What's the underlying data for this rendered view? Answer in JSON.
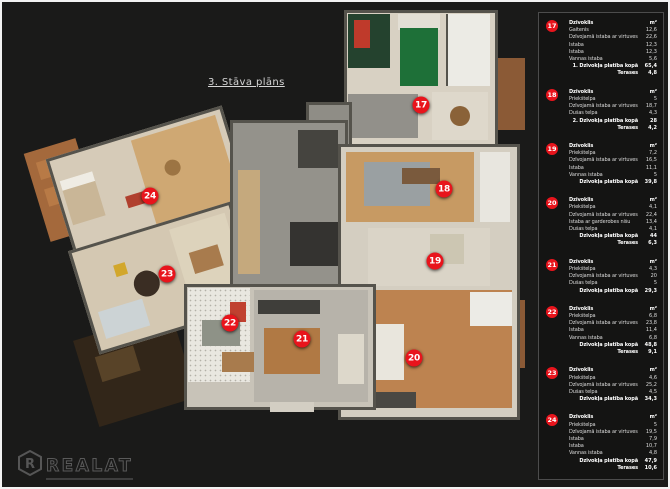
{
  "title": "3. Stāva plāns",
  "logo": {
    "symbol": "R",
    "text": "REALAT"
  },
  "plan": {
    "marker_color": "#e8141c",
    "markers": [
      {
        "id": "17",
        "x": 419,
        "y": 103
      },
      {
        "id": "18",
        "x": 442,
        "y": 187
      },
      {
        "id": "19",
        "x": 433,
        "y": 259
      },
      {
        "id": "20",
        "x": 412,
        "y": 356
      },
      {
        "id": "21",
        "x": 300,
        "y": 337
      },
      {
        "id": "22",
        "x": 228,
        "y": 321
      },
      {
        "id": "23",
        "x": 165,
        "y": 272
      },
      {
        "id": "24",
        "x": 148,
        "y": 194
      }
    ]
  },
  "sidebar": {
    "header_label": "Dzīvoklis",
    "unit_label": "m²",
    "apartments": [
      {
        "id": "17",
        "rows": [
          [
            "Gaitenis",
            "12,6"
          ],
          [
            "Dzīvojamā istaba ar virtuves nišu",
            "22,6"
          ],
          [
            "Istaba",
            "12,3"
          ],
          [
            "Istaba",
            "12,3"
          ],
          [
            "Vannas istaba",
            "5,6"
          ]
        ],
        "totals": [
          [
            "1. Dzīvokļa platība kopā",
            "65,4"
          ],
          [
            "Terases",
            "4,8"
          ]
        ]
      },
      {
        "id": "18",
        "rows": [
          [
            "Priekštelpa",
            "5"
          ],
          [
            "Dzīvojamā istaba ar virtuves zonu",
            "18,7"
          ],
          [
            "Dušas telpa",
            "4,3"
          ]
        ],
        "totals": [
          [
            "2. Dzīvokļa platība kopā",
            "28"
          ],
          [
            "Terases",
            "4,2"
          ]
        ]
      },
      {
        "id": "19",
        "rows": [
          [
            "Priekštelpa",
            "7,2"
          ],
          [
            "Dzīvojamā istaba ar virtuves zonu",
            "16,5"
          ],
          [
            "Istaba",
            "11,1"
          ],
          [
            "Vannas istaba",
            "5"
          ]
        ],
        "totals": [
          [
            "Dzīvokļa platība kopā",
            "39,8"
          ]
        ]
      },
      {
        "id": "20",
        "rows": [
          [
            "Priekštelpa",
            "4,1"
          ],
          [
            "Dzīvojamā istaba ar virtuves nišu",
            "22,4"
          ],
          [
            "Istaba ar garderobes nišu",
            "13,4"
          ],
          [
            "Dušas telpa",
            "4,1"
          ]
        ],
        "totals": [
          [
            "Dzīvokļa platība kopā",
            "44"
          ],
          [
            "Terases",
            "6,3"
          ]
        ]
      },
      {
        "id": "21",
        "rows": [
          [
            "Priekštelpa",
            "4,3"
          ],
          [
            "Dzīvojamā istaba ar virtuves zonu",
            "20"
          ],
          [
            "Dušas telpa",
            "5"
          ]
        ],
        "totals": [
          [
            "Dzīvokļa platība kopā",
            "29,3"
          ]
        ]
      },
      {
        "id": "22",
        "rows": [
          [
            "Priekštelpa",
            "6,8"
          ],
          [
            "Dzīvojamā istaba ar virtuves zonu",
            "23,8"
          ],
          [
            "Istaba",
            "11,4"
          ],
          [
            "Vannas istaba",
            "6,8"
          ]
        ],
        "totals": [
          [
            "Dzīvokļa platība kopā",
            "48,8"
          ],
          [
            "Terases",
            "9,1"
          ]
        ]
      },
      {
        "id": "23",
        "rows": [
          [
            "Priekštelpa",
            "4,6"
          ],
          [
            "Dzīvojamā istaba ar virtuves zonu",
            "25,2"
          ],
          [
            "Dušas telpa",
            "4,5"
          ]
        ],
        "totals": [
          [
            "Dzīvokļa platība kopā",
            "34,3"
          ]
        ]
      },
      {
        "id": "24",
        "rows": [
          [
            "Priekštelpa",
            "5"
          ],
          [
            "Dzīvojamā istaba ar virtuves zonu",
            "19,5"
          ],
          [
            "Istaba",
            "7,9"
          ],
          [
            "Istaba",
            "10,7"
          ],
          [
            "Vannas istaba",
            "4,8"
          ]
        ],
        "totals": [
          [
            "Dzīvokļa platība kopā",
            "47,9"
          ],
          [
            "Terases",
            "10,6"
          ]
        ]
      }
    ]
  }
}
